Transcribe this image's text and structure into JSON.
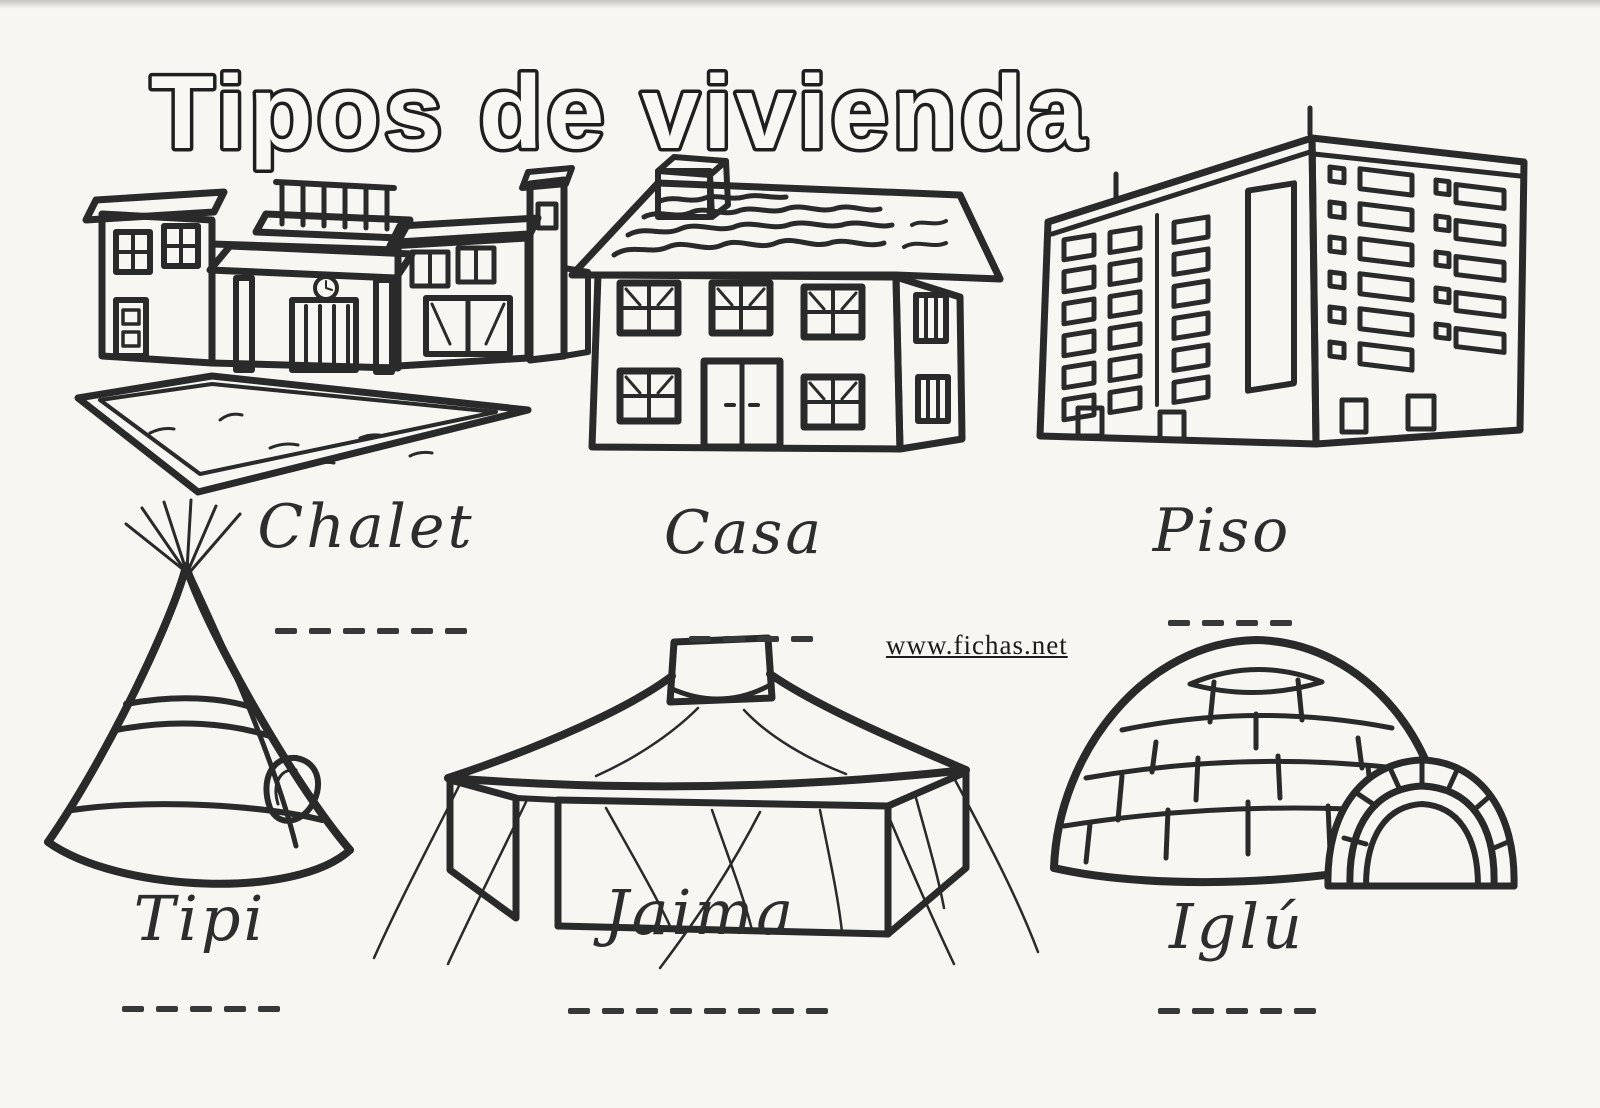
{
  "page": {
    "title": "Tipos de vivienda",
    "watermark": "www.fichas.net",
    "colors": {
      "ink": "#2a2a2a",
      "paper": "#f7f6f2"
    }
  },
  "items": [
    {
      "id": "chalet",
      "label": "Chalet",
      "dash_count": 6
    },
    {
      "id": "casa",
      "label": "Casa",
      "dash_count": 4
    },
    {
      "id": "piso",
      "label": "Piso",
      "dash_count": 4
    },
    {
      "id": "tipi",
      "label": "Tipi",
      "dash_count": 5
    },
    {
      "id": "jaima",
      "label": "Jaima",
      "dash_count": 8
    },
    {
      "id": "iglu",
      "label": "Iglú",
      "dash_count": 5
    }
  ]
}
